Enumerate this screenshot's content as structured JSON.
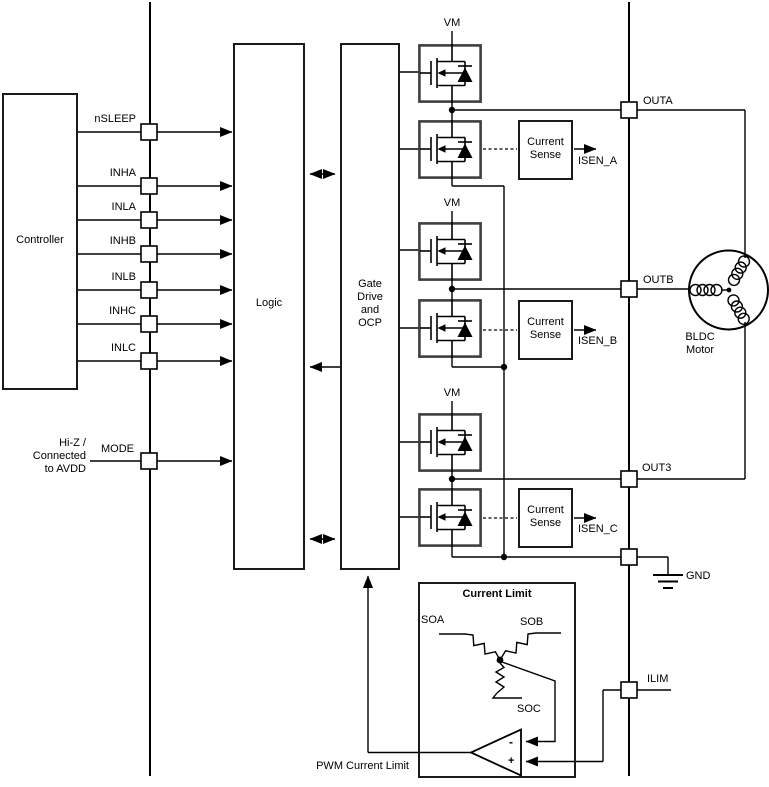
{
  "controller": {
    "label": "Controller"
  },
  "input_pins": [
    {
      "label": "nSLEEP"
    },
    {
      "label": "INHA"
    },
    {
      "label": "INLA"
    },
    {
      "label": "INHB"
    },
    {
      "label": "INLB"
    },
    {
      "label": "INHC"
    },
    {
      "label": "INLC"
    }
  ],
  "mode": {
    "label": "MODE",
    "note_lines": [
      "Hi-Z /",
      "Connected",
      "to AVDD"
    ]
  },
  "logic": {
    "label": "Logic"
  },
  "gate_drive": {
    "lines": [
      "Gate",
      "Drive",
      "and",
      "OCP"
    ]
  },
  "vm": "VM",
  "current_sense": {
    "lines": [
      "Current",
      "Sense"
    ]
  },
  "isen": [
    "ISEN_A",
    "ISEN_B",
    "ISEN_C"
  ],
  "outputs": [
    {
      "label": "OUTA"
    },
    {
      "label": "OUTB"
    },
    {
      "label": "OUT3"
    }
  ],
  "gnd": {
    "label": "GND"
  },
  "ilim": {
    "label": "ILIM"
  },
  "motor": {
    "lines": [
      "BLDC",
      "Motor"
    ]
  },
  "current_limit": {
    "title": "Current Limit",
    "soa": "SOA",
    "sob": "SOB",
    "soc": "SOC",
    "minus": "-",
    "plus": "+",
    "output_label": "PWM Current Limit"
  },
  "colors": {
    "wire": "#000000",
    "fet_border": "#3f3f3f",
    "background": "#ffffff"
  }
}
